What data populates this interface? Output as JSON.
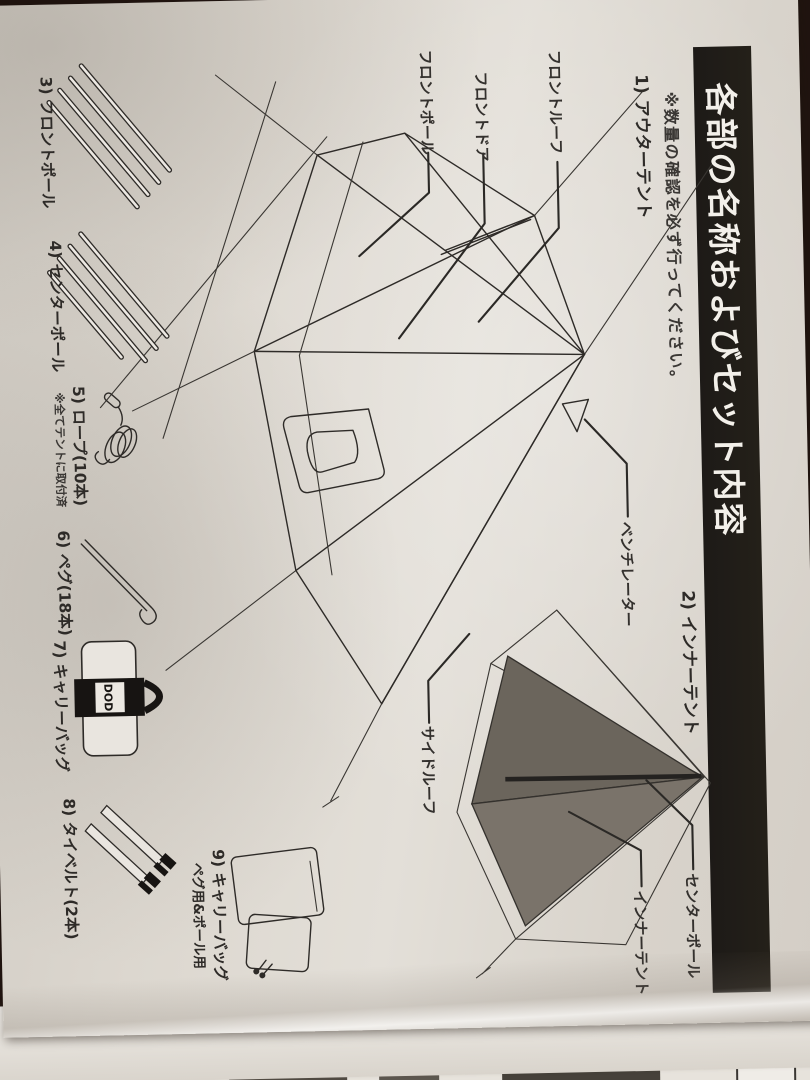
{
  "header": {
    "title": "各部の名称およびセット内容",
    "note": "※数量の確認を必ず行ってください。"
  },
  "sections": {
    "outer_tent": "1) アウターテント",
    "inner_tent": "2) インナーテント"
  },
  "part_labels": {
    "front_roof": "フロントルーフ",
    "front_door": "フロントドア",
    "front_pole": "フロントポール",
    "ventilator": "ベンチレーター",
    "side_roof": "サイドルーフ",
    "center_pole": "センターポール",
    "inner_tent": "インナーテント"
  },
  "items": [
    {
      "label": "3) フロントポール"
    },
    {
      "label": "4) センターポール"
    },
    {
      "label": "5) ロープ(10本)",
      "note": "※全てテントに取付済"
    },
    {
      "label": "6) ペグ(18本)"
    },
    {
      "label": "7) キャリーバッグ"
    },
    {
      "label": "8) タイベルト(2本)"
    },
    {
      "label": "9) キャリーバッグ",
      "sublabel": "ペグ用&ポール用"
    }
  ],
  "logo": {
    "bag_text": "DOD"
  },
  "colors": {
    "paper": "#dcd7cf",
    "ink": "#2e2b28",
    "header_bg": "#1d1a17",
    "header_text": "#f3f0ea",
    "wood": "#4a2d18",
    "inner_tent_fill": "#6b655c"
  }
}
